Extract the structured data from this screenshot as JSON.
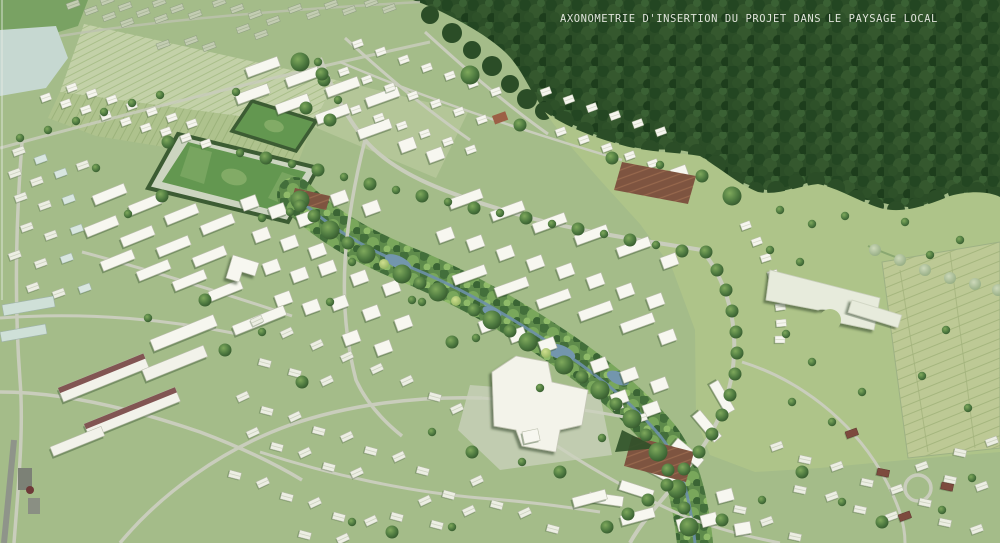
{
  "caption": {
    "text": "AXONOMETRIE D'INSERTION DU PROJET DANS LE PAYSAGE LOCAL"
  },
  "palette": {
    "base": "#a4bc89",
    "forest": "#2b4d27",
    "meadow": "#aec489",
    "field_light": "#c3d1a8",
    "field_mid": "#aec28d",
    "pond": "#c6d8d1",
    "stream": "#6d90a8",
    "road": "#c9cdbc",
    "pitch": "#639750",
    "pitch_track": "#ccd5c0",
    "pitch_marking": "#82ab66",
    "hedge": "#3c5c33",
    "building_new": "#f7f7f0",
    "building_town": "#eceee3",
    "village_roof": "#c3cdb2",
    "industrial_roof": "#6e3a38",
    "allotment_soil": "#7e5440",
    "caption_color": "#dfe3da"
  },
  "scene": {
    "regions": [
      "existing-village-and-fields",
      "woodland",
      "meadow",
      "new-district-housing",
      "stream-green-corridor",
      "sports-fields",
      "crescent-housing-arc",
      "allotment-gardens",
      "existing-town",
      "industrial-sheds"
    ]
  }
}
